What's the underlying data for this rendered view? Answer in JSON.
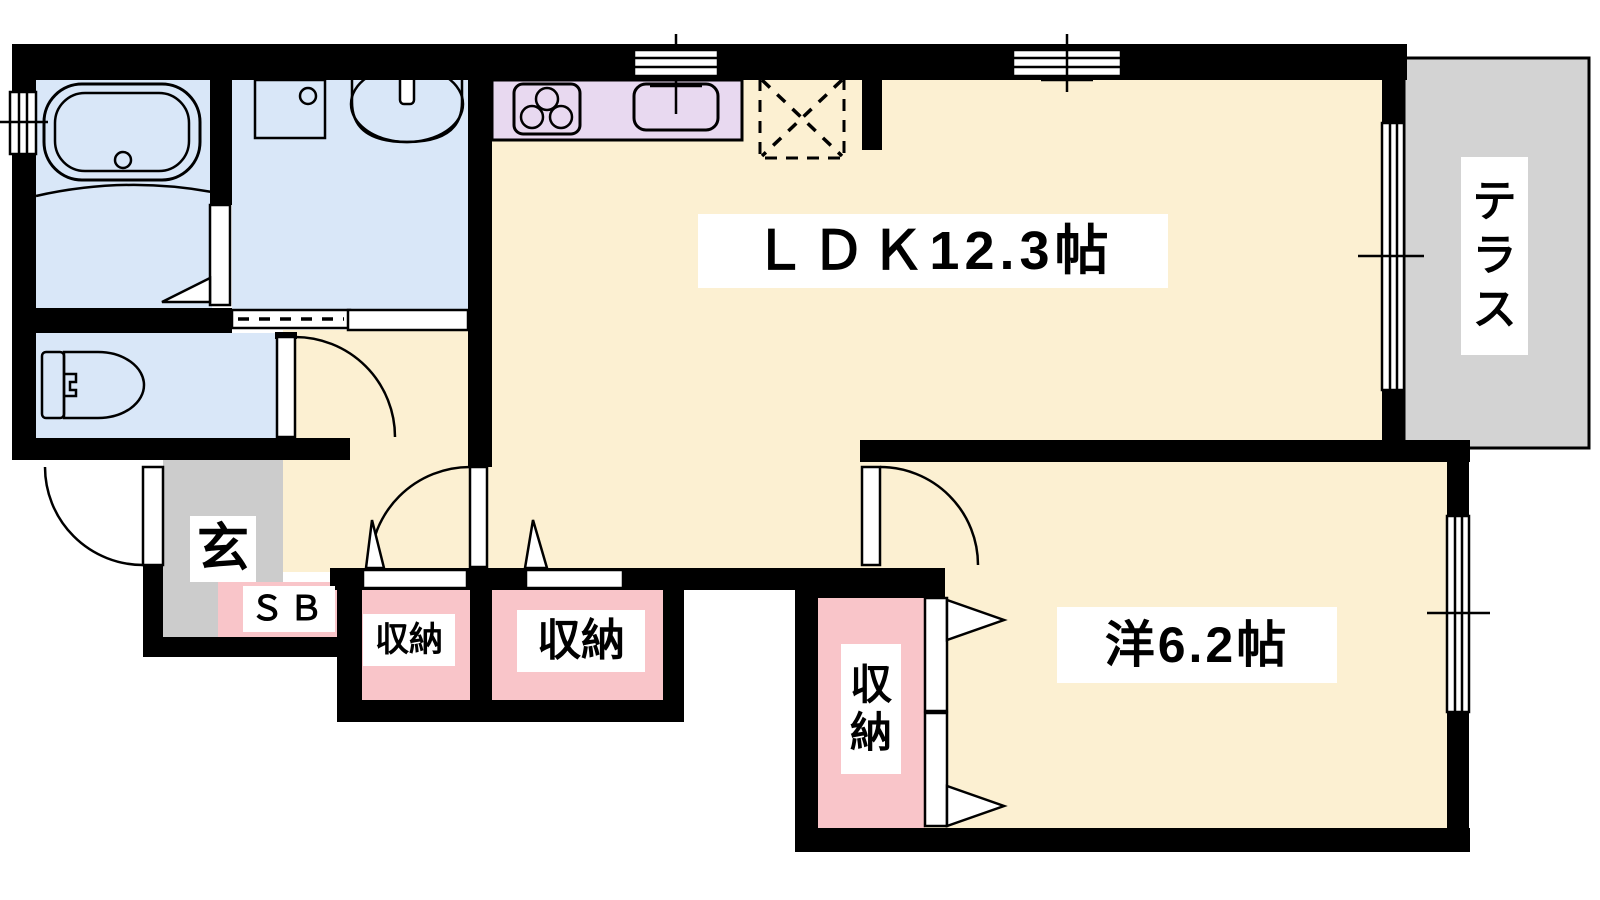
{
  "colors": {
    "bg": "#ffffff",
    "wall": "#000000",
    "outline": "#000000",
    "label-bg": "#ffffff",
    "text": "#000000",
    "room-water": "#d9e7f8",
    "room-main": "#fcf0d2",
    "kitchen-counter": "#e8d9f0",
    "storage-pink": "#f9c5c9",
    "entrance-gray": "#cccccc",
    "terrace-gray": "#d3d3d3"
  },
  "rooms": {
    "ldk": {
      "label": "ＬＤＫ12.3帖"
    },
    "western_room": {
      "label": "洋6.2帖"
    },
    "terrace": {
      "label": "テラス",
      "chars": [
        "テ",
        "ラ",
        "ス"
      ]
    },
    "entrance": {
      "label": "玄"
    },
    "shoe_box": {
      "label": "ＳＢ"
    },
    "storage_hall_small": {
      "label": "収納"
    },
    "storage_hall_large": {
      "label": "収納"
    },
    "storage_bedroom": {
      "label": "収納",
      "chars": [
        "収",
        "納"
      ]
    }
  },
  "icons": {
    "bathtub-icon": "rounded rectangle tub with drain circle",
    "washer-pan-icon": "square pan with drain circle",
    "vanity-sink-icon": "oval basin with faucet",
    "toilet-icon": "tank and bowl outline",
    "stove-icon": "three-burner cooktop",
    "kitchen-sink-icon": "rounded rectangle sink with faucet",
    "fridge-space-icon": "dashed square with X",
    "door-swing-icon": "quarter-circle swing arc",
    "sliding-door-icon": "double-line sash",
    "window-icon": "double-line window in wall",
    "folding-door-icon": "triangle direction marker"
  }
}
